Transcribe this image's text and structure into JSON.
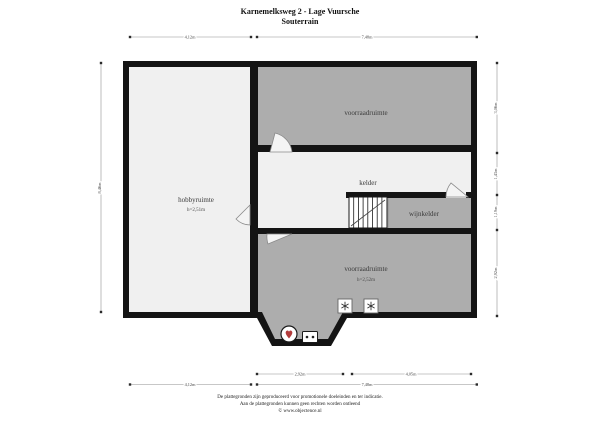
{
  "title": {
    "line1": "Karnemelksweg 2 - Lage Vuursche",
    "line2": "Souterrain"
  },
  "rooms": {
    "hobbyruimte": {
      "label": "hobbyruimte",
      "height": "h=2,51m"
    },
    "voorraadruimte_top": {
      "label": "voorraadruimte"
    },
    "kelder": {
      "label": "kelder"
    },
    "wijnkelder": {
      "label": "wijnkelder"
    },
    "voorraadruimte_bottom": {
      "label": "voorraadruimte",
      "height": "h=2,52m"
    }
  },
  "dimensions": {
    "top_left": "4,12m",
    "top_right": "7,48m",
    "left": "8,46m",
    "right_top": "3,06m",
    "right_kelder": "1,43m",
    "right_wijnkelder": "1,19m",
    "right_bottom": "2,92m",
    "bottom_inner_left": "2,92m",
    "bottom_inner_right": "4,05m",
    "bottom_outer_left": "4,12m",
    "bottom_outer_right": "7,48m"
  },
  "icons": {
    "boiler": "cv-boiler",
    "ventilation_left": "ventilation",
    "ventilation_right": "ventilation",
    "socket": "meter-socket"
  },
  "footer": {
    "line1": "De plattegronden zijn geproduceerd voor promotionele doeleinden en ter indicatie.",
    "line2": "Aan de plattegronden kunnen geen rechten worden ontleend",
    "line3": "© www.objectence.nl"
  },
  "colors": {
    "wall": "#141414",
    "room_light": "#f0f0f0",
    "room_dark": "#adadad",
    "accent_red": "#b23b3b"
  }
}
